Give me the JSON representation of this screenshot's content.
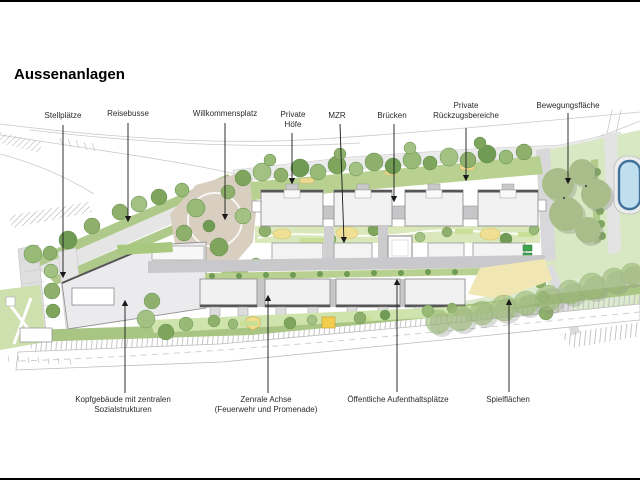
{
  "title": "Aussenanlagen",
  "annotations": [
    {
      "id": "stellplaetze",
      "lines": [
        "Stellplätze",
        ""
      ]
    },
    {
      "id": "reisebusse",
      "lines": [
        "Reisebusse",
        ""
      ]
    },
    {
      "id": "willkommensplatz",
      "lines": [
        "Willkommensplatz",
        ""
      ]
    },
    {
      "id": "private-hoefe",
      "lines": [
        "Private",
        "Höfe"
      ]
    },
    {
      "id": "mzr",
      "lines": [
        "MZR",
        ""
      ]
    },
    {
      "id": "bruecken",
      "lines": [
        "Brücken",
        ""
      ]
    },
    {
      "id": "private-rueckzugsbereiche",
      "lines": [
        "Private",
        "Rückzugsbereiche"
      ]
    },
    {
      "id": "bewegungsflaeche",
      "lines": [
        "Bewegungsfläche",
        ""
      ]
    },
    {
      "id": "kopfgebaeude",
      "lines": [
        "Kopfgebäude mit zentralen",
        "Sozialstrukturen"
      ]
    },
    {
      "id": "zentrale-achse",
      "lines": [
        "Zenrale Achse",
        "(Feuerwehr und Promenade)"
      ]
    },
    {
      "id": "oeffentliche-aufenthaltsplaetze",
      "lines": [
        "Öffentliche Aufenthaltsplätze",
        ""
      ]
    },
    {
      "id": "spielflaechen",
      "lines": [
        "Spielflächen",
        ""
      ]
    }
  ],
  "colors": {
    "background": "#ffffff",
    "building_fill": "#f1f1f2",
    "building_dark_edge": "#565656",
    "path_gray": "#c9c9cc",
    "road_gray": "#e5e5e6",
    "tree_green": "#8fb06c",
    "strip_green": "#aec98b",
    "lawn_green": "#d8e8c2",
    "plaza_beige": "#d9cfc0",
    "play_yellow": "#f0dc8a",
    "pool_water": "#bfdfee",
    "pool_edge": "#3f719b",
    "arrow_black": "#1a1a1a"
  }
}
